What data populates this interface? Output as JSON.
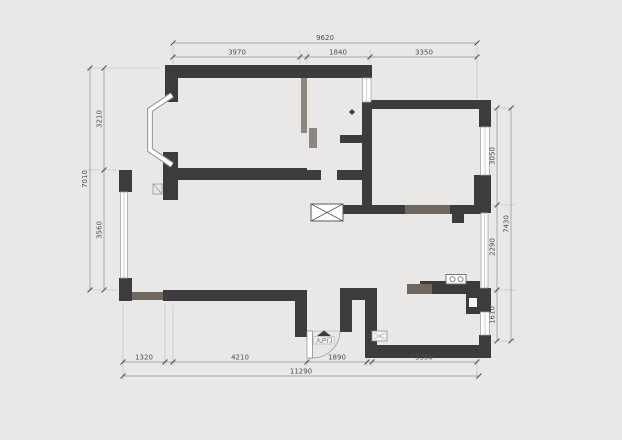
{
  "drawing": {
    "type": "residential floor plan",
    "labels": {
      "entry_door": "入户门"
    }
  },
  "colors": {
    "background": "#e9e8e7",
    "wall_dark": "#3c3b3d",
    "wall_medium": "#6f6760",
    "wall_light": "#8d8780",
    "window_fill": "#fdfdfd",
    "dimension_text": "#4f4f4f"
  },
  "dimensions": {
    "top": {
      "overall": "9620",
      "segments": [
        "3970",
        "1840",
        "3350"
      ]
    },
    "bottom": {
      "overall": "11290",
      "segments": [
        "1320",
        "4210",
        "1890",
        "3350"
      ]
    },
    "left": {
      "overall": "7010",
      "segments": [
        "3210",
        "3560"
      ]
    },
    "right": {
      "overall": "7430",
      "segments": [
        "3050",
        "2290",
        "1610"
      ]
    }
  }
}
